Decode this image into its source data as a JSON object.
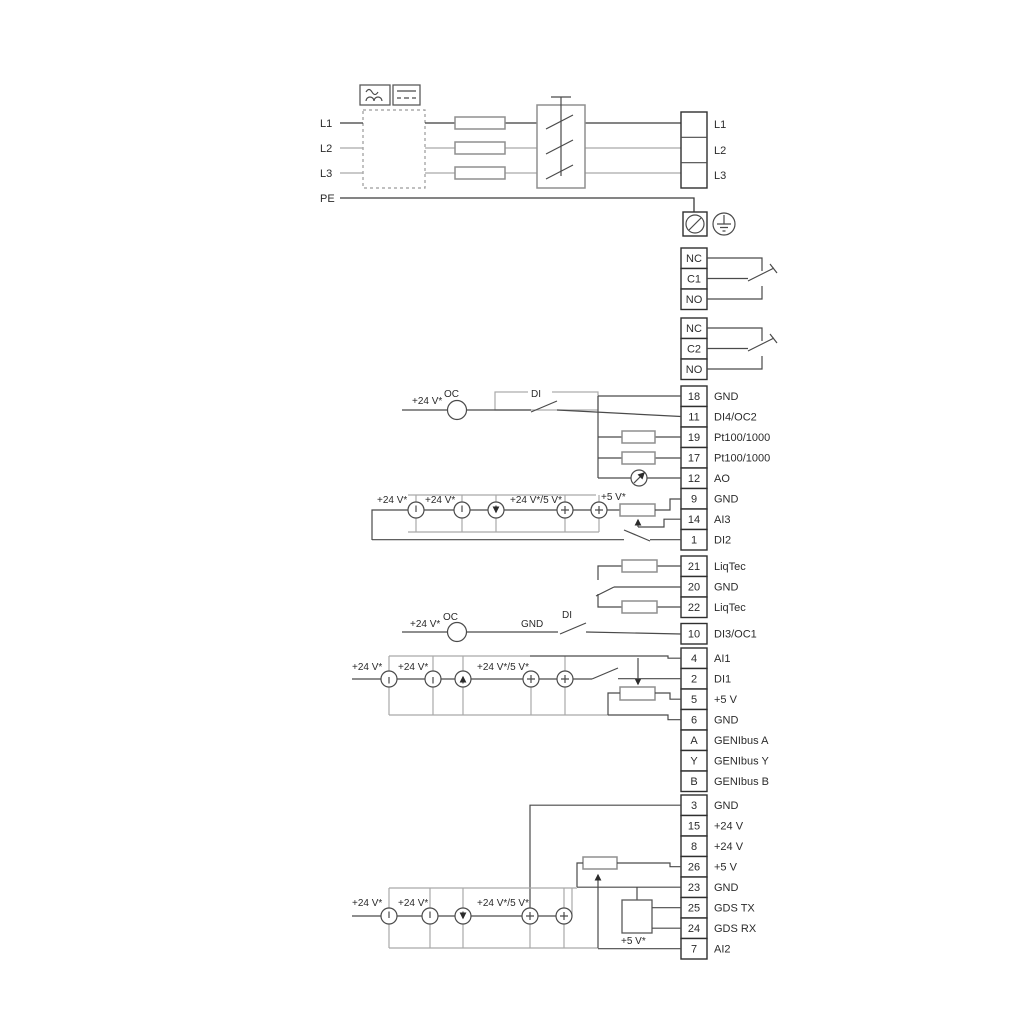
{
  "labels": {
    "p24": "+24 V*",
    "p245": "+24 V*/5 V*",
    "p5": "+5 V*",
    "oc": "OC",
    "di": "DI",
    "gnd": "GND"
  },
  "power": {
    "in": [
      "L1",
      "L2",
      "L3",
      "PE"
    ],
    "out": [
      "L1",
      "L2",
      "L3"
    ]
  },
  "relays": {
    "r1": [
      "NC",
      "C1",
      "NO"
    ],
    "r2": [
      "NC",
      "C2",
      "NO"
    ]
  },
  "g1": [
    {
      "n": "18",
      "l": "GND"
    },
    {
      "n": "11",
      "l": "DI4/OC2"
    },
    {
      "n": "19",
      "l": "Pt100/1000"
    },
    {
      "n": "17",
      "l": "Pt100/1000"
    },
    {
      "n": "12",
      "l": "AO"
    },
    {
      "n": "9",
      "l": "GND"
    },
    {
      "n": "14",
      "l": "AI3"
    },
    {
      "n": "1",
      "l": "DI2"
    }
  ],
  "g2": [
    {
      "n": "21",
      "l": "LiqTec"
    },
    {
      "n": "20",
      "l": "GND"
    },
    {
      "n": "22",
      "l": "LiqTec"
    }
  ],
  "g3": [
    {
      "n": "10",
      "l": "DI3/OC1"
    }
  ],
  "g4": [
    {
      "n": "4",
      "l": "AI1"
    },
    {
      "n": "2",
      "l": "DI1"
    },
    {
      "n": "5",
      "l": "+5 V"
    },
    {
      "n": "6",
      "l": "GND"
    },
    {
      "n": "A",
      "l": "GENIbus A"
    },
    {
      "n": "Y",
      "l": "GENIbus Y"
    },
    {
      "n": "B",
      "l": "GENIbus B"
    }
  ],
  "g5": [
    {
      "n": "3",
      "l": "GND"
    },
    {
      "n": "15",
      "l": "+24 V"
    },
    {
      "n": "8",
      "l": "+24 V"
    },
    {
      "n": "26",
      "l": "+5 V"
    },
    {
      "n": "23",
      "l": "GND"
    },
    {
      "n": "25",
      "l": "GDS TX"
    },
    {
      "n": "24",
      "l": "GDS RX"
    },
    {
      "n": "7",
      "l": "AI2"
    }
  ]
}
